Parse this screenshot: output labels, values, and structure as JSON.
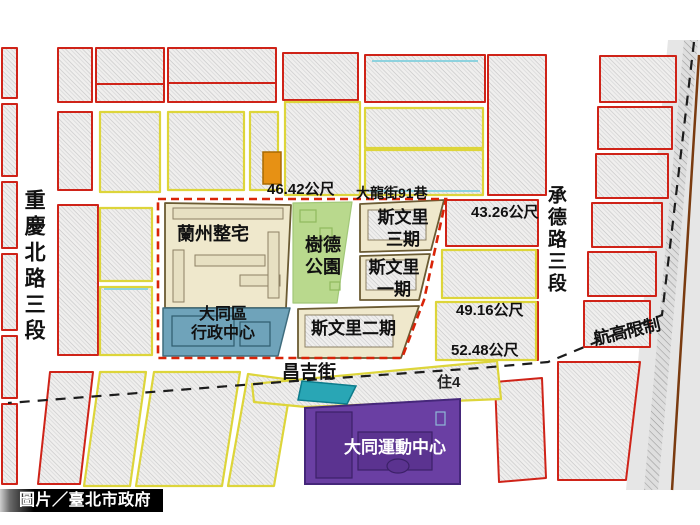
{
  "streets": {
    "chongqing_n_rd": "重慶北路三段",
    "chengde_rd": "承德路三段",
    "changji_st": "昌吉街",
    "dalong_lane": "大龍街91巷"
  },
  "zones": {
    "lanzhou": "蘭州整宅",
    "shude_park": [
      "樹德",
      "公園"
    ],
    "siwenli_p3": [
      "斯文里",
      "三期"
    ],
    "siwenli_p1": [
      "斯文里",
      "一期"
    ],
    "siwenli_p2": "斯文里二期",
    "datong_admin": [
      "大同區",
      "行政中心"
    ],
    "datong_sports": "大同運動中心"
  },
  "measurements": {
    "m1": "46.42公尺",
    "m2": "43.26公尺",
    "m3": "49.16公尺",
    "m4": "52.48公尺"
  },
  "annotations": {
    "height_limit": "航高限制",
    "zoning": "住4"
  },
  "credit": {
    "label": "圖片／臺北市政府"
  },
  "colors": {
    "boundary_red": "#d92408",
    "block_red": "#cf2318",
    "block_yellow": "#ddd53a",
    "zone_cream": "#efe8cc",
    "park_green": "#b9d98d",
    "admin_teal": "#6fa3ba",
    "sports_purple": "#6a3fa3",
    "pool_teal": "#29a6b5",
    "highlight_orange": "#e79114"
  }
}
